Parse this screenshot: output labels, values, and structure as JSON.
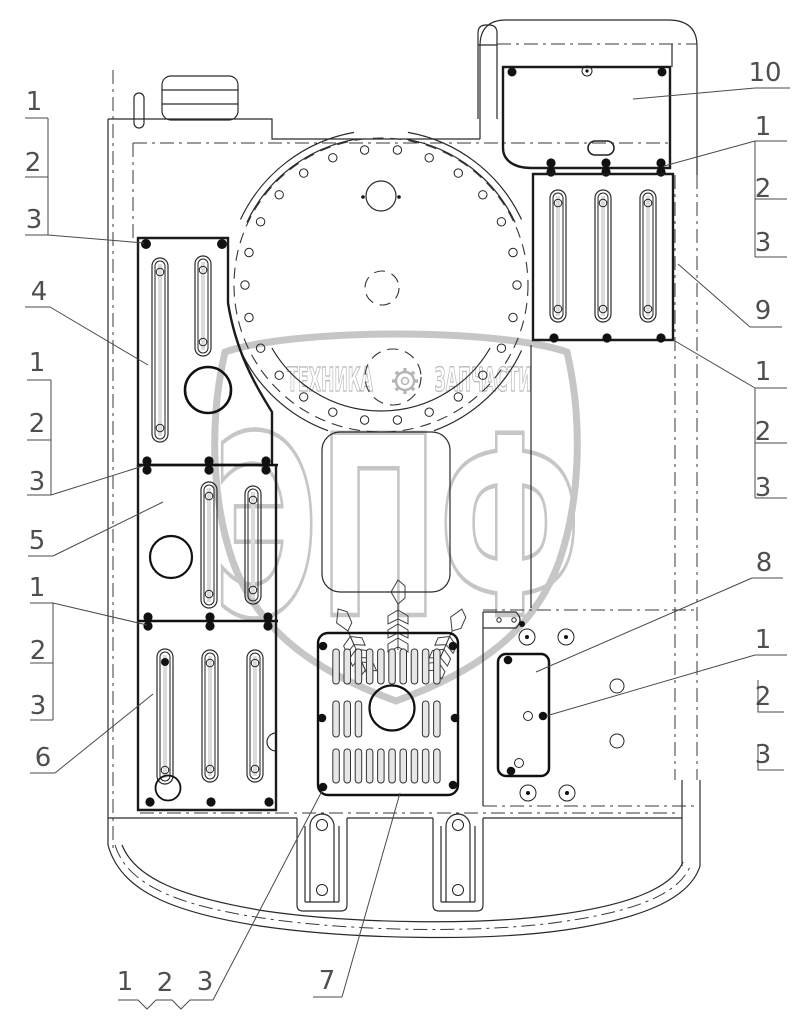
{
  "diagram": {
    "type": "technical-parts-drawing",
    "watermark": {
      "brand": "ЭПФ",
      "tagline_left": "ТЕХНИКА",
      "tagline_right": "ЗАПЧАСТИ",
      "gear_icon": "gear",
      "color": "#c6c6c6"
    },
    "line_color": "#222222",
    "background": "#ffffff",
    "callouts": [
      {
        "id": "left-upper-1",
        "label": "1"
      },
      {
        "id": "left-upper-2",
        "label": "2"
      },
      {
        "id": "left-upper-3",
        "label": "3"
      },
      {
        "id": "part-4",
        "label": "4"
      },
      {
        "id": "left-mid-1",
        "label": "1"
      },
      {
        "id": "left-mid-2",
        "label": "2"
      },
      {
        "id": "left-mid-3",
        "label": "3"
      },
      {
        "id": "part-5",
        "label": "5"
      },
      {
        "id": "left-lower-1",
        "label": "1"
      },
      {
        "id": "left-lower-2",
        "label": "2"
      },
      {
        "id": "left-lower-3",
        "label": "3"
      },
      {
        "id": "part-6",
        "label": "6"
      },
      {
        "id": "bottom-1",
        "label": "1"
      },
      {
        "id": "bottom-2",
        "label": "2"
      },
      {
        "id": "bottom-3",
        "label": "3"
      },
      {
        "id": "part-7",
        "label": "7"
      },
      {
        "id": "part-10",
        "label": "10"
      },
      {
        "id": "right-upper-1",
        "label": "1"
      },
      {
        "id": "right-upper-2",
        "label": "2"
      },
      {
        "id": "right-upper-3",
        "label": "3"
      },
      {
        "id": "part-9",
        "label": "9"
      },
      {
        "id": "right-mid-1",
        "label": "1"
      },
      {
        "id": "right-mid-2",
        "label": "2"
      },
      {
        "id": "right-mid-3",
        "label": "3"
      },
      {
        "id": "part-8",
        "label": "8"
      },
      {
        "id": "right-lower-1",
        "label": "1"
      },
      {
        "id": "right-lower-2",
        "label": "2"
      },
      {
        "id": "right-lower-3",
        "label": "3"
      }
    ]
  }
}
